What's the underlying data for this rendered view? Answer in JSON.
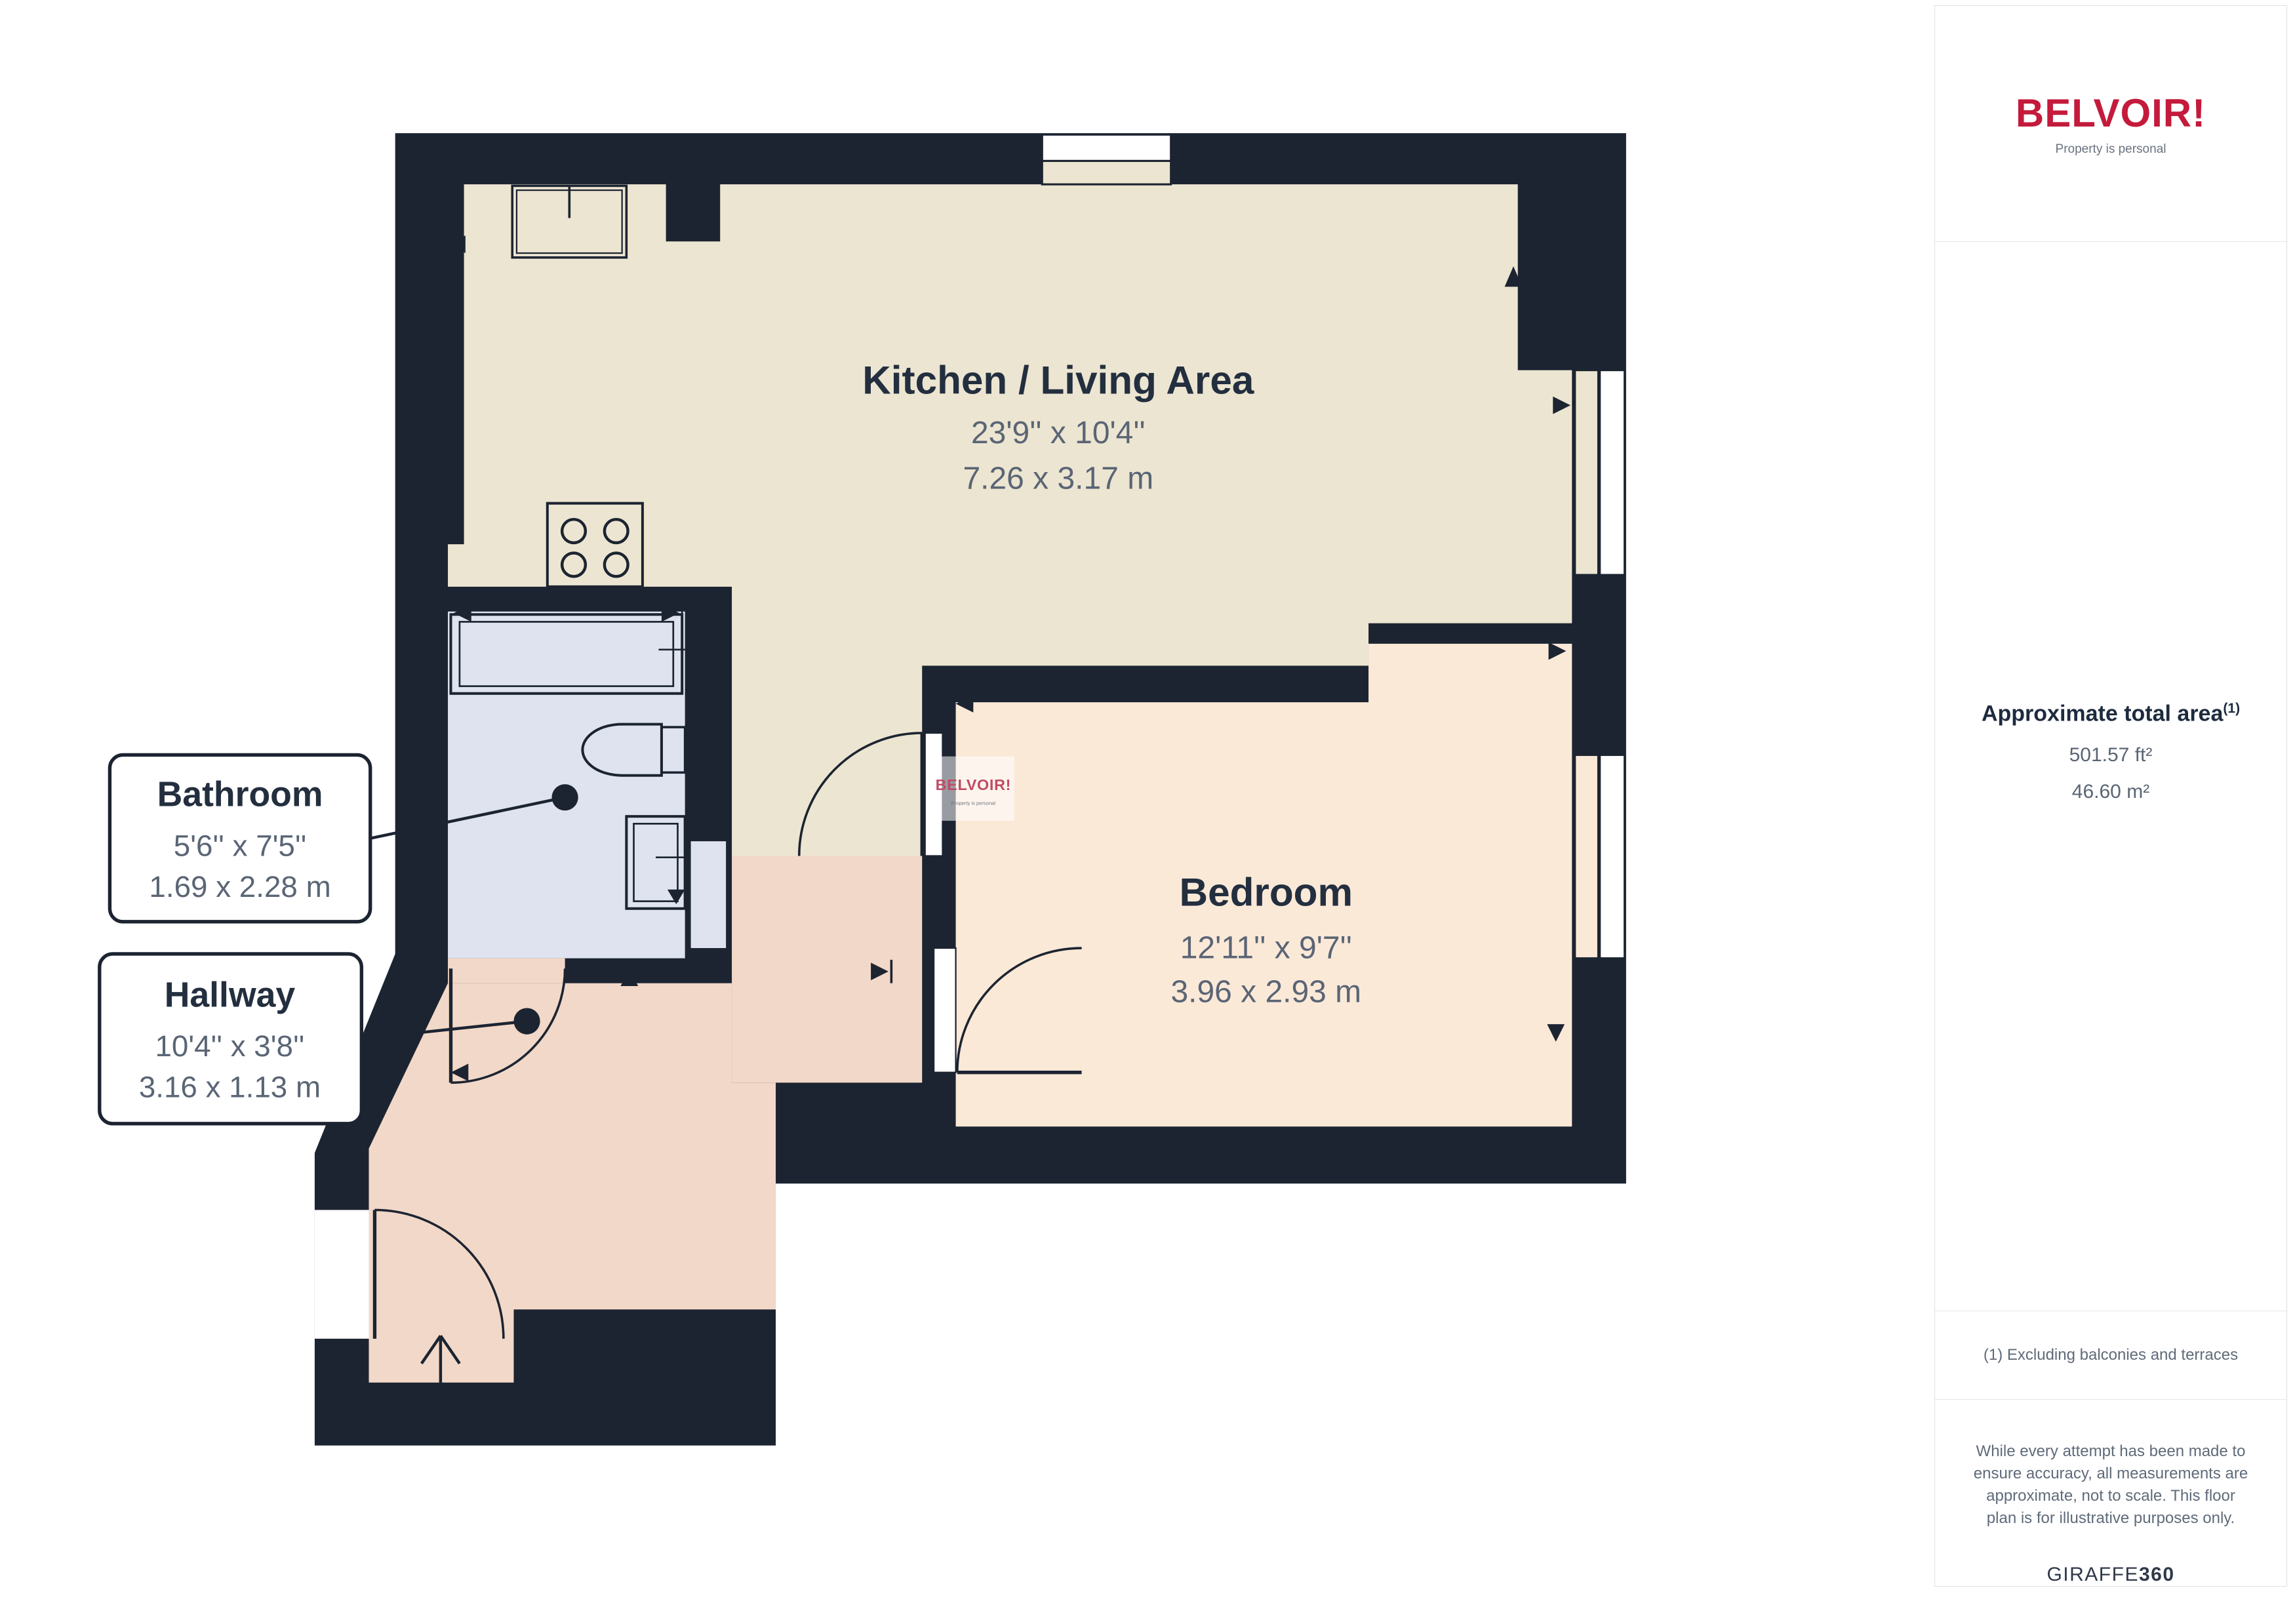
{
  "plan": {
    "rooms": {
      "kitchen": {
        "name": "Kitchen / Living Area",
        "imperial": "23'9'' x 10'4''",
        "metric": "7.26 x 3.17 m"
      },
      "bedroom": {
        "name": "Bedroom",
        "imperial": "12'11'' x 9'7''",
        "metric": "3.96 x 2.93 m"
      },
      "bathroom": {
        "name": "Bathroom",
        "imperial": "5'6'' x 7'5''",
        "metric": "1.69 x 2.28 m"
      },
      "hallway": {
        "name": "Hallway",
        "imperial": "10'4'' x 3'8''",
        "metric": "3.16 x 1.13 m"
      }
    },
    "watermark": {
      "brand": "BELVOIR!",
      "tagline": "Property is personal"
    },
    "colors": {
      "wall": "#1c2431",
      "kitchen_floor": "#ece5d1",
      "bedroom_floor": "#fbe9d8",
      "bathroom_floor": "#dee3ef",
      "hallway_floor": "#f2d8c8",
      "brand_red": "#c41a3b"
    }
  },
  "sidebar": {
    "brand": "BELVOIR!",
    "brand_tagline": "Property is personal",
    "area": {
      "heading": "Approximate total area",
      "heading_sup": "(1)",
      "imperial": "501.57 ft²",
      "metric": "46.60 m²"
    },
    "footnote": "(1) Excluding balconies and terraces",
    "disclaimer": "While every attempt has been made to ensure accuracy, all measurements are approximate, not to scale. This floor plan is for illustrative purposes only.",
    "credit": {
      "name": "GIRAFFE",
      "suffix": "360"
    }
  }
}
